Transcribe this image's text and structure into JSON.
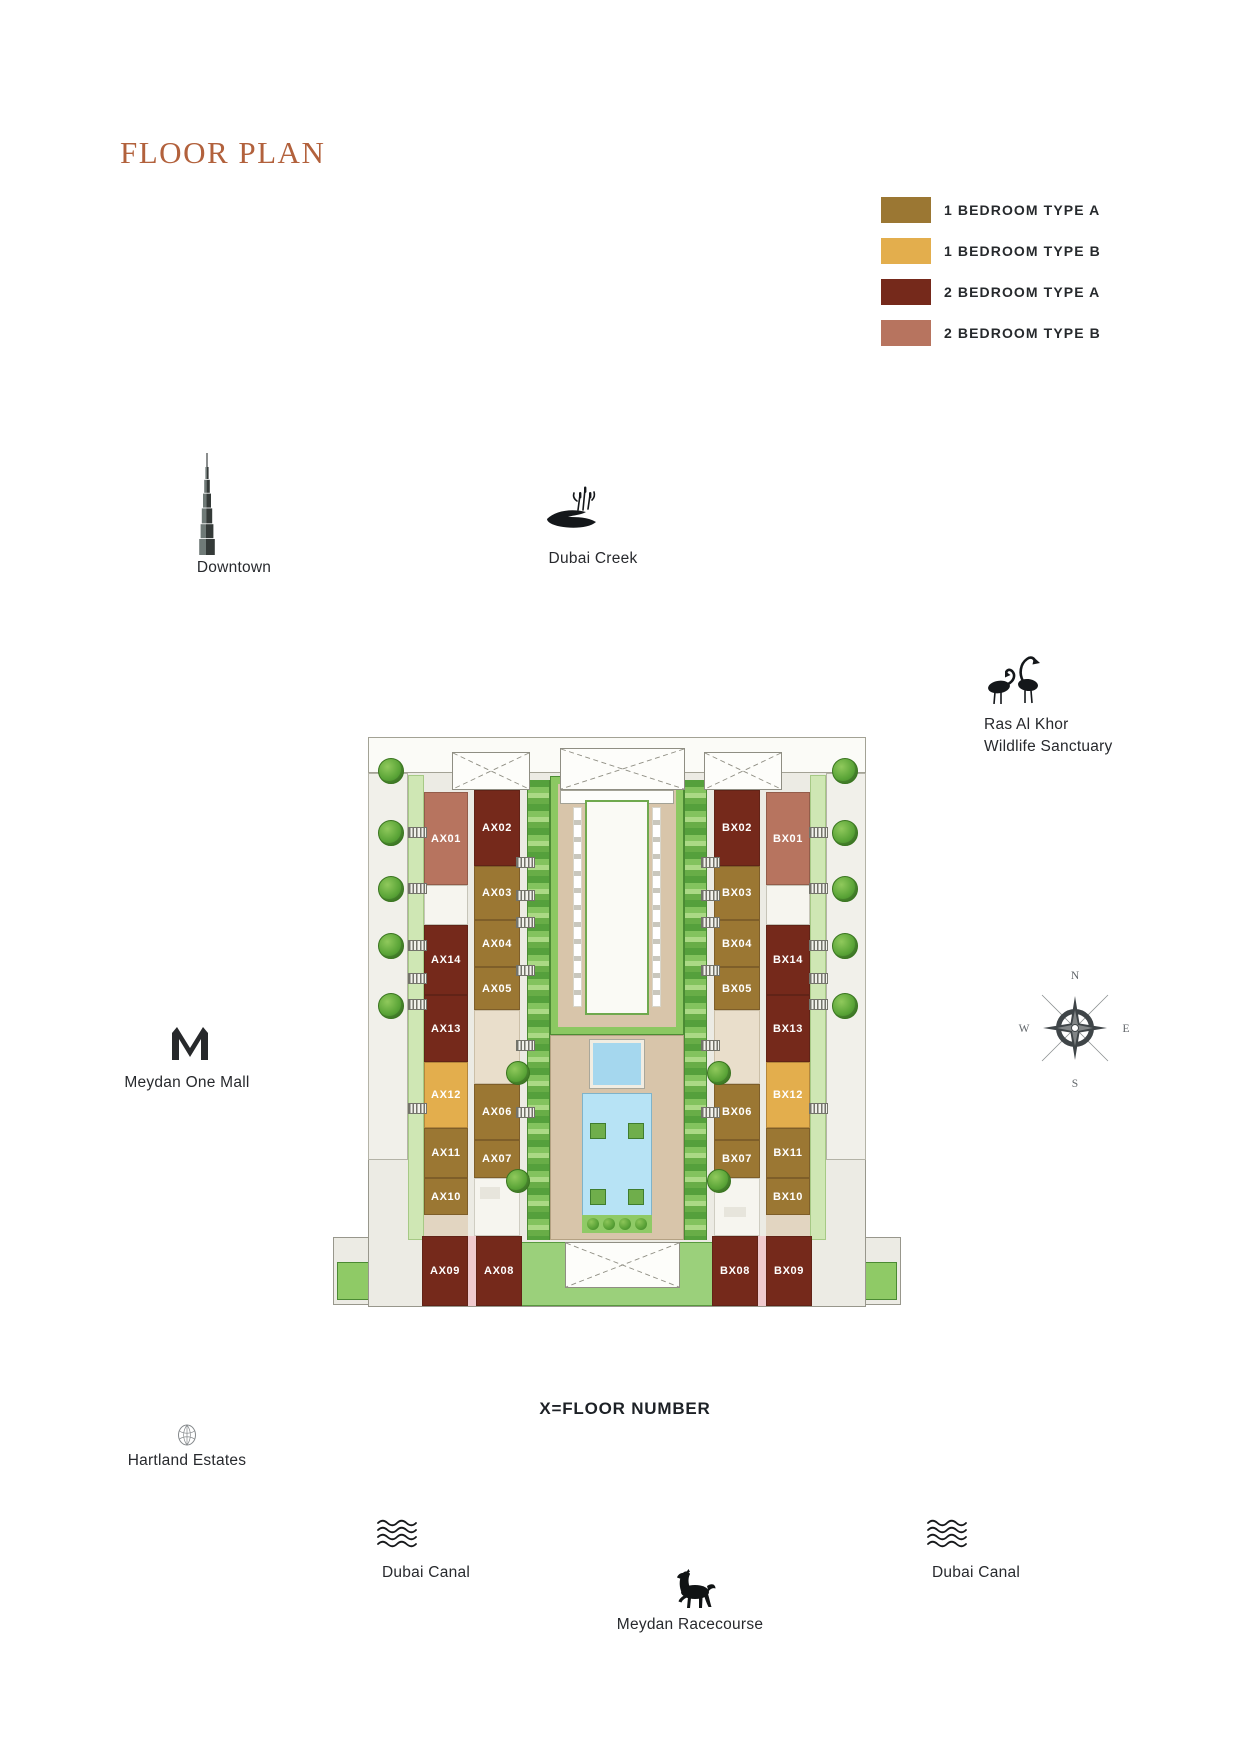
{
  "page": {
    "title": "FLOOR PLAN",
    "floor_note": "X=FLOOR NUMBER"
  },
  "legend": {
    "items": [
      {
        "key": "1A",
        "label": "1 BEDROOM TYPE A",
        "color": "#9b7733"
      },
      {
        "key": "1B",
        "label": "1 BEDROOM TYPE B",
        "color": "#e3ae4d"
      },
      {
        "key": "2A",
        "label": "2 BEDROOM TYPE A",
        "color": "#75291b"
      },
      {
        "key": "2B",
        "label": "2 BEDROOM TYPE B",
        "color": "#b7745f"
      }
    ]
  },
  "landmarks": {
    "downtown": {
      "label": "Downtown"
    },
    "dubai_creek": {
      "label": "Dubai Creek"
    },
    "ras_al_khor": {
      "label_line1": "Ras Al Khor",
      "label_line2": "Wildlife Sanctuary"
    },
    "meydan_one_mall": {
      "label": "Meydan One Mall"
    },
    "hartland_estates": {
      "label": "Hartland Estates"
    },
    "dubai_canal_west": {
      "label": "Dubai Canal"
    },
    "dubai_canal_east": {
      "label": "Dubai Canal"
    },
    "meydan_racecourse": {
      "label": "Meydan Racecourse"
    }
  },
  "compass": {
    "n": "N",
    "e": "E",
    "s": "S",
    "w": "W"
  },
  "floorplan": {
    "units": [
      {
        "id": "AX01",
        "type": "2B"
      },
      {
        "id": "AX02",
        "type": "2A"
      },
      {
        "id": "AX03",
        "type": "1A"
      },
      {
        "id": "AX04",
        "type": "1A"
      },
      {
        "id": "AX05",
        "type": "1A"
      },
      {
        "id": "AX06",
        "type": "1A"
      },
      {
        "id": "AX07",
        "type": "1A"
      },
      {
        "id": "AX08",
        "type": "2A"
      },
      {
        "id": "AX09",
        "type": "2A"
      },
      {
        "id": "AX10",
        "type": "1A"
      },
      {
        "id": "AX11",
        "type": "1A"
      },
      {
        "id": "AX12",
        "type": "1B"
      },
      {
        "id": "AX13",
        "type": "2A"
      },
      {
        "id": "AX14",
        "type": "2A"
      },
      {
        "id": "BX01",
        "type": "2B"
      },
      {
        "id": "BX02",
        "type": "2A"
      },
      {
        "id": "BX03",
        "type": "1A"
      },
      {
        "id": "BX04",
        "type": "1A"
      },
      {
        "id": "BX05",
        "type": "1A"
      },
      {
        "id": "BX06",
        "type": "1A"
      },
      {
        "id": "BX07",
        "type": "1A"
      },
      {
        "id": "BX08",
        "type": "2A"
      },
      {
        "id": "BX09",
        "type": "2A"
      },
      {
        "id": "BX10",
        "type": "1A"
      },
      {
        "id": "BX11",
        "type": "1A"
      },
      {
        "id": "BX12",
        "type": "1B"
      },
      {
        "id": "BX13",
        "type": "2A"
      },
      {
        "id": "BX14",
        "type": "2A"
      }
    ]
  }
}
